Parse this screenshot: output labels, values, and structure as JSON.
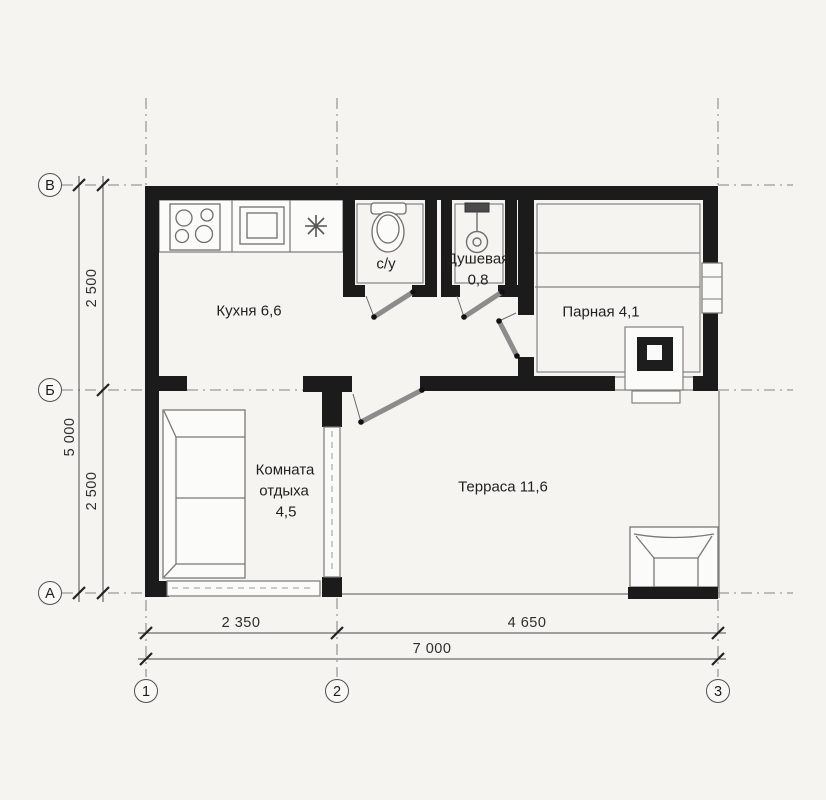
{
  "plan_title": "Sauna floor plan",
  "rooms": {
    "kitchen": {
      "label": "Кухня 6,6"
    },
    "wc": {
      "label": "с/у"
    },
    "shower": {
      "label": "Душевая",
      "area": "0,8"
    },
    "steam": {
      "label": "Парная 4,1"
    },
    "lounge": {
      "line1": "Комната",
      "line2": "отдыха",
      "area": "4,5"
    },
    "terrace": {
      "label": "Терраса 11,6"
    }
  },
  "axes": {
    "row_top": "В",
    "row_mid": "Б",
    "row_bottom": "А",
    "col_left": "1",
    "col_mid": "2",
    "col_right": "3"
  },
  "dims": {
    "v_seg_top": "2 500",
    "v_seg_bottom": "2 500",
    "v_total": "5 000",
    "h_seg_left": "2 350",
    "h_seg_right": "4 650",
    "h_total": "7 000"
  },
  "colors": {
    "wall": "#1b1b1b",
    "thin_line": "#787878",
    "dash_line": "#9a9a9a",
    "background": "#f5f4f1",
    "text": "#1f1f1f"
  },
  "icons": {
    "hob": "hob-icon",
    "sink": "sink-icon",
    "lamp": "asterisk-lamp-icon",
    "toilet": "toilet-icon",
    "shower_head": "shower-head-icon",
    "sauna_stove": "sauna-stove-icon",
    "sofa": "sofa-icon",
    "table": "table-icon"
  }
}
